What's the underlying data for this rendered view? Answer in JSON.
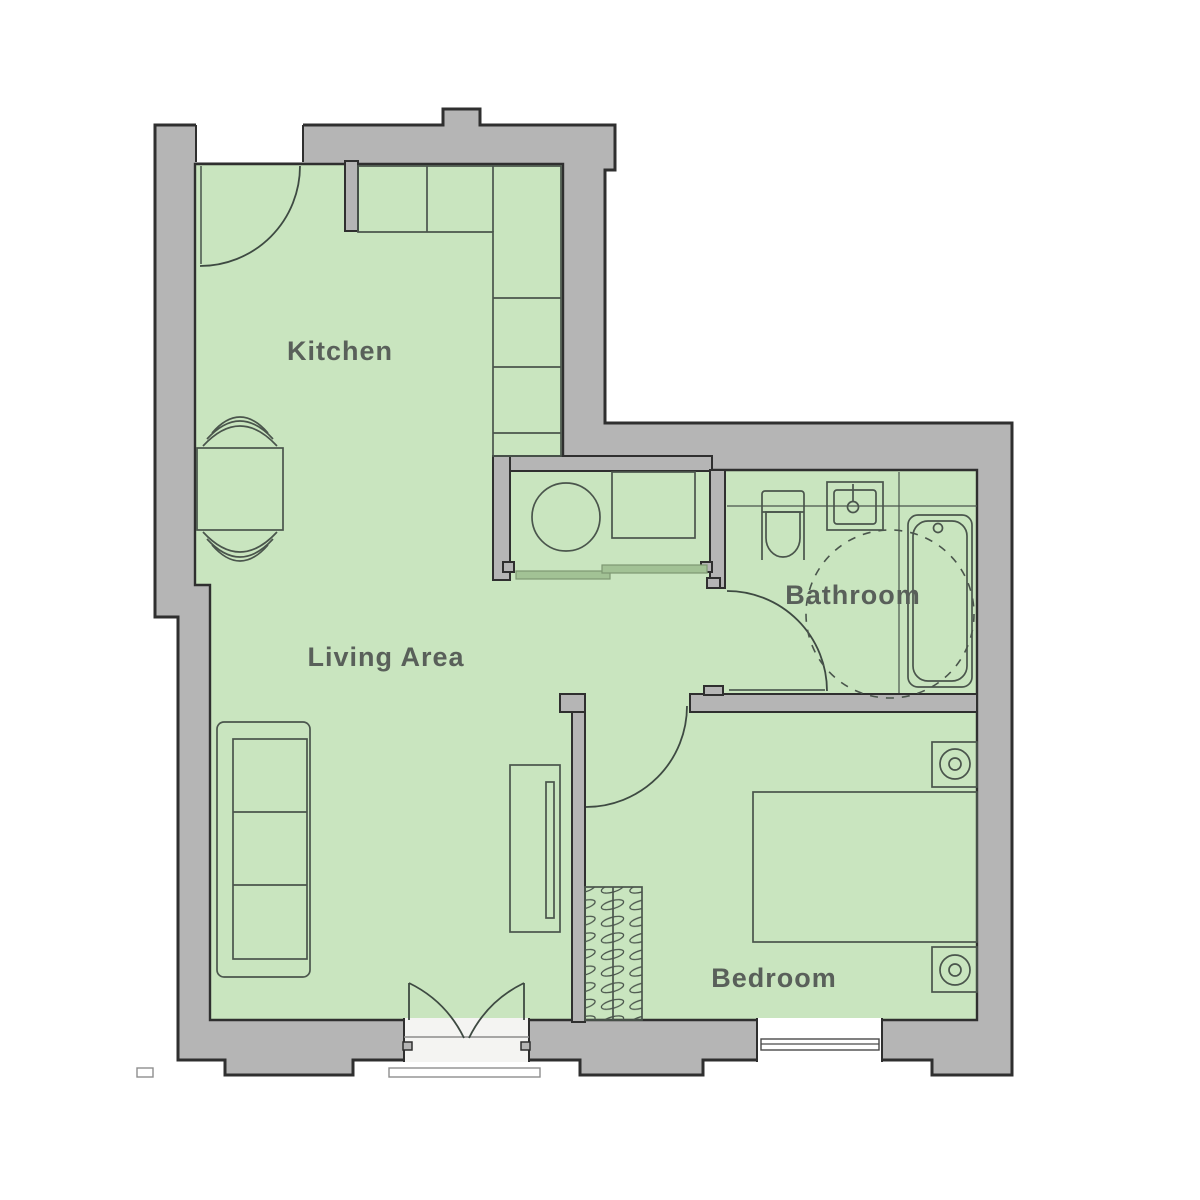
{
  "title": "One-bedroom apartment floor plan",
  "rooms": {
    "kitchen": {
      "label": "Kitchen"
    },
    "living": {
      "label": "Living Area"
    },
    "bathroom": {
      "label": "Bathroom"
    },
    "bedroom": {
      "label": "Bedroom"
    }
  },
  "colors": {
    "background": "#ffffff",
    "wall_fill": "#b5b5b5",
    "wall_outline": "#2f2f2f",
    "floor": "#c9e5bf",
    "furniture_line": "#4a554c",
    "door_arc": "#3e4a42",
    "sliding_door_fill": "#a2c295",
    "label_text": "#59605a"
  },
  "fixtures": [
    "entrance-door",
    "kitchen-counter",
    "wall-stub",
    "dining-table",
    "dining-chair",
    "sofa",
    "tv-unit",
    "french-doors",
    "washing-machine",
    "utility-counter",
    "sliding-doors",
    "toilet",
    "bathroom-sink",
    "bathtub",
    "accessibility-turning-circle",
    "bathroom-door",
    "bedroom-door",
    "bed",
    "nightstand",
    "table-lamp",
    "wardrobe",
    "bedroom-window"
  ]
}
